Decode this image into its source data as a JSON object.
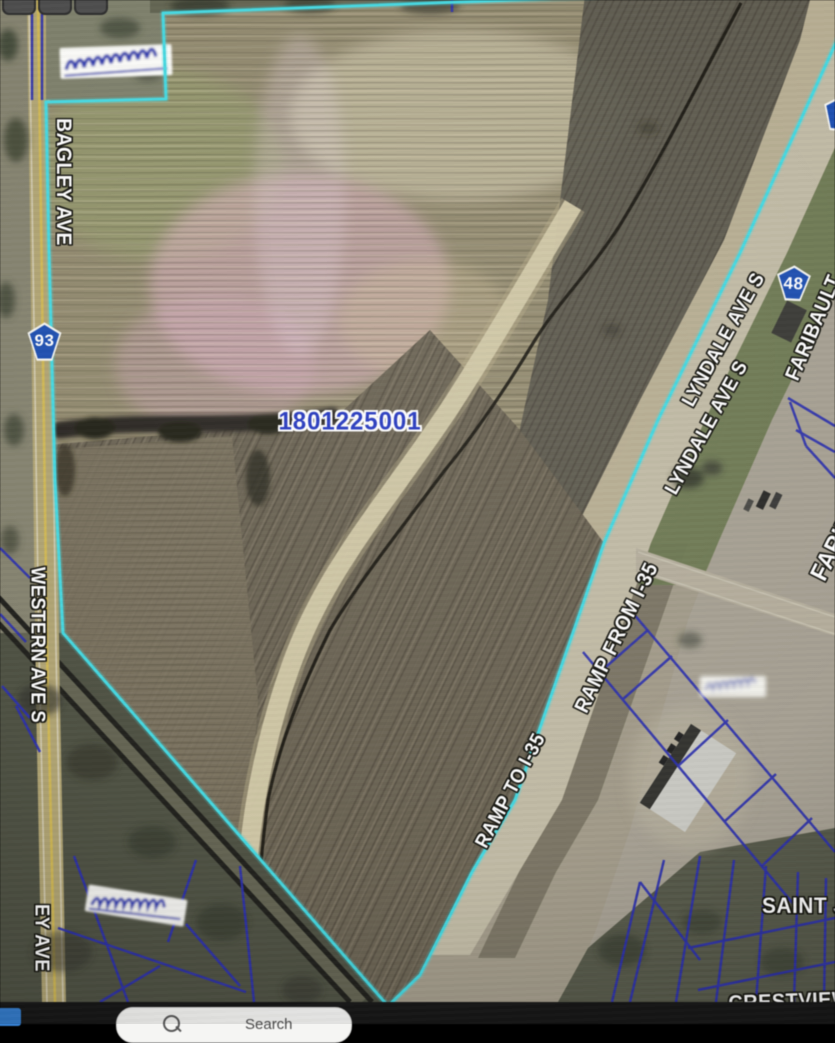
{
  "taskbar": {
    "search_placeholder": "Search"
  },
  "map": {
    "parcel_id": "1801225001",
    "labels": {
      "bagley": "BAGLEY AVE",
      "western": "WESTERN AVE S",
      "ey": "EY AVE",
      "lyndale_upper": "LYNDALE AVE S",
      "lyndale_lower": "LYNDALE AVE S",
      "faribault": "FARIBAULT",
      "faribault_partial": "FARIBAULT",
      "ramp_from": "RAMP FROM I-35",
      "ramp_to": "RAMP TO I-35",
      "saint": "SAINT J",
      "crestview": "CRESTVIEW"
    },
    "shields": {
      "route_93": "93",
      "route_48": "48"
    },
    "colors": {
      "selected_parcel_outline": "#3DDBE4",
      "parcel_lines": "#2B2FB5",
      "parcel_id_text": "#2438C8",
      "shield_fill": "#1A4FB8"
    }
  }
}
